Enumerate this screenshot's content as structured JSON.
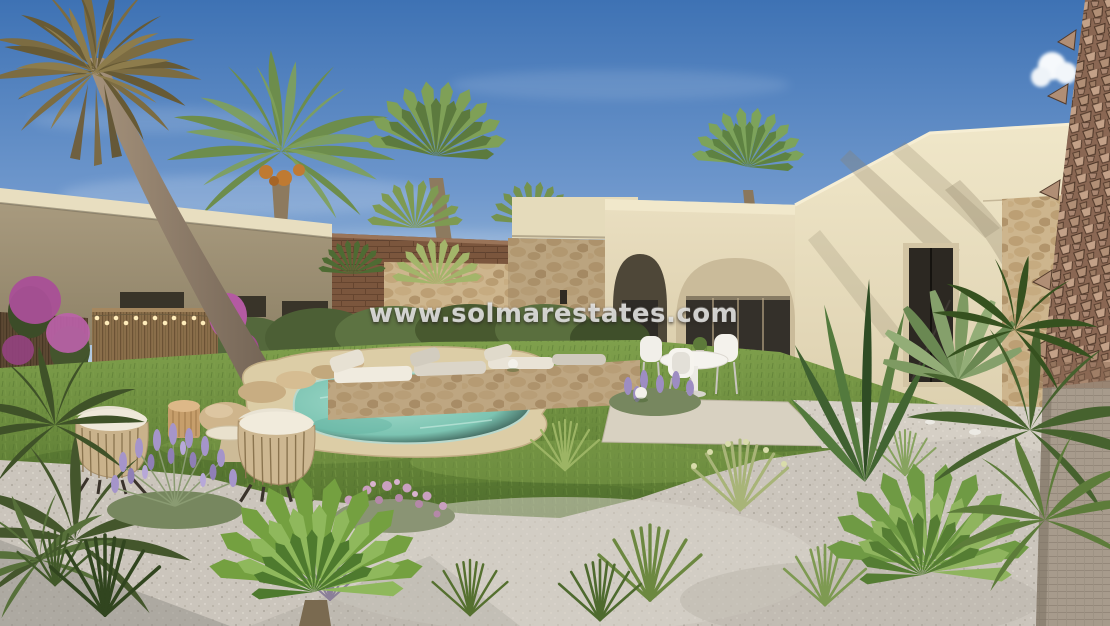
{
  "scene": {
    "kind": "exterior-3d-render",
    "subject": "single-storey cream villa with arched porch, private kidney-shaped pool, lawn and gravel mediterranean garden, palm trees",
    "watermark": {
      "text": "www.solmarestates.com"
    }
  },
  "palette": {
    "sky_top": "#3e72b4",
    "sky_horizon": "#cfdde9",
    "villa_cream": "#e9dfc0",
    "villa_shadow": "#b9a98a",
    "stone_cladding": "#c7ad84",
    "brick_wall": "#7b563d",
    "reed_fence": "#8a6e4a",
    "pool_water": "#6fbfae",
    "pool_coping": "#dccda6",
    "lawn_green": "#6b8c3e",
    "gravel": "#ccc6bd",
    "lavender": "#a393c8",
    "bougainvillea": "#bb5aa6",
    "palm_green": "#7fa057",
    "palm_trunk": "#a3988a",
    "string_light": "#ffedbb",
    "watermark_text": "#ececea"
  }
}
